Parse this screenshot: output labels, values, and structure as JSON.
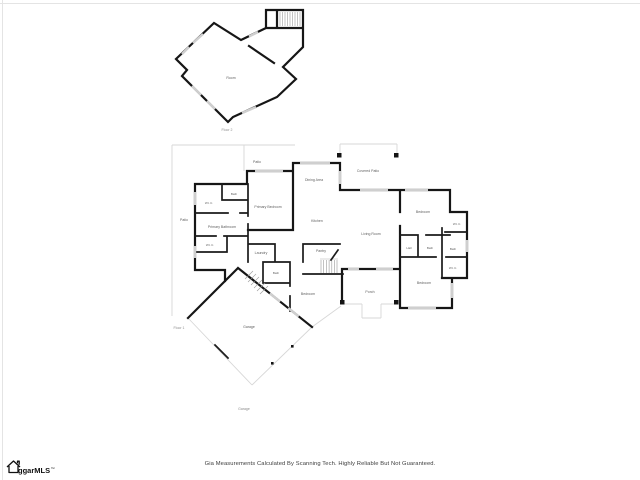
{
  "plan": {
    "floor2": {
      "room": "Room",
      "section_label": "Floor 2"
    },
    "floor1": {
      "section_label": "Floor 1",
      "patio_top": "Patio",
      "patio_left": "Patio",
      "dining": "Dining Area",
      "covered_patio": "Covered Patio",
      "kitchen": "Kitchen",
      "living_room": "Living Room",
      "primary_bedroom": "Primary Bedroom",
      "primary_bathroom": "Primary Bathroom",
      "bath": "Bath",
      "wic_1": "W.I.C.",
      "wic_2": "W.I.C.",
      "laundry": "Laundry",
      "pantry": "Pantry",
      "bath_center": "Bath",
      "bedroom_center": "Bedroom",
      "porch": "Porch",
      "bedroom_right_top": "Bedroom",
      "wic_right_top": "W.I.C.",
      "hall": "Hall",
      "bath_right_1": "Bath",
      "bath_right_2": "Bath",
      "wic_right_bottom": "W.I.C.",
      "bedroom_right_bottom": "Bedroom"
    },
    "garage": {
      "room": "Garage",
      "section_label": "Garage"
    }
  },
  "footer": {
    "disclaimer": "Gia Measurements Calculated By Scanning Tech. Highly Reliable But Not Guaranteed.",
    "logo_text": "ggarMLS",
    "logo_trademark": "™"
  },
  "colors": {
    "wall": "#161616",
    "window": "#cfcfcf",
    "thin_line": "#d7d7d7",
    "label": "#5f5f5f",
    "background": "#ffffff"
  }
}
